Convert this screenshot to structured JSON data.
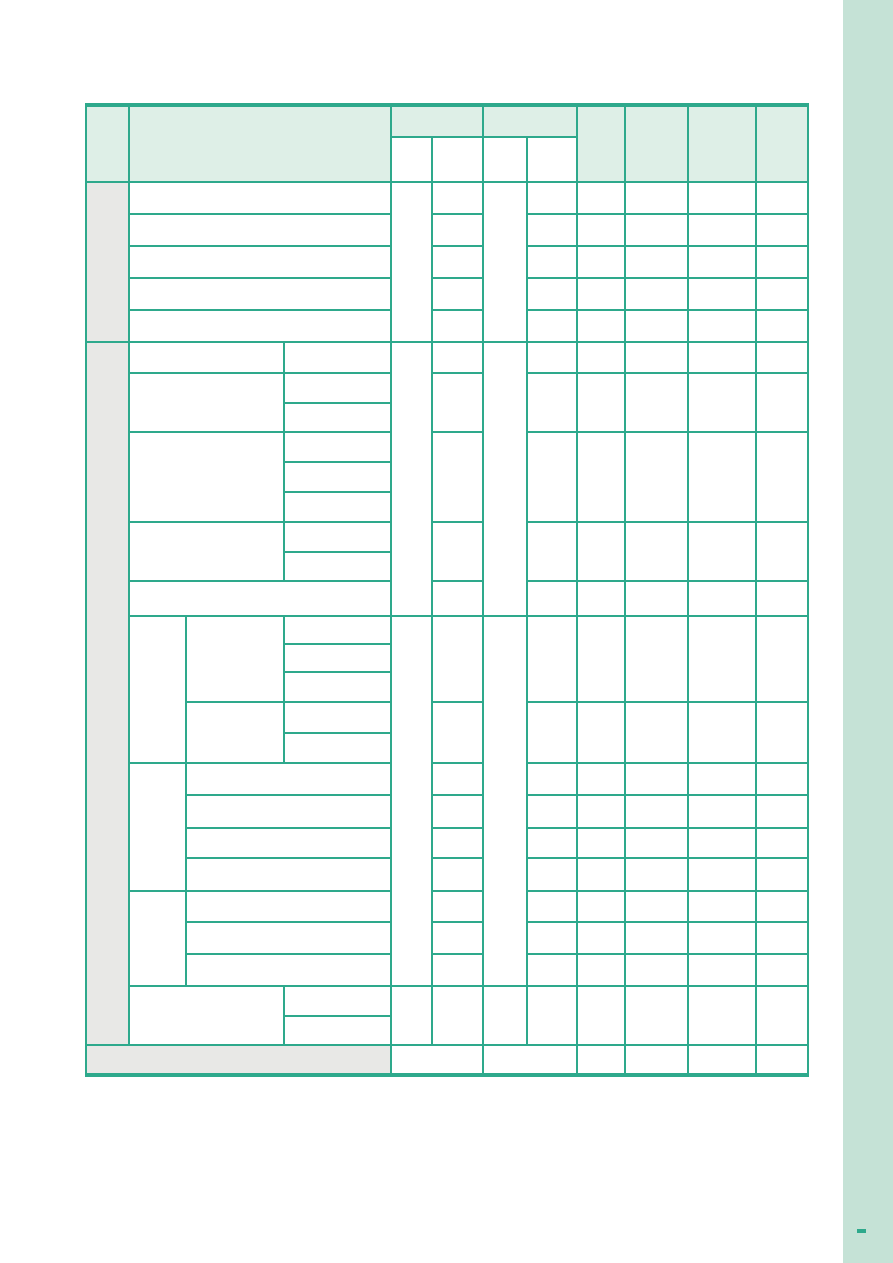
{
  "colors": {
    "page_bg": "#ffffff",
    "table_line": "#2ea98c",
    "header_fill": "#deefe7",
    "label_fill": "#e8e8e6",
    "cell_fill": "#ffffff",
    "side_bar": "#c5e2d6",
    "page_marker": "#2ea98c"
  },
  "table": {
    "all_cells_empty": true
  }
}
